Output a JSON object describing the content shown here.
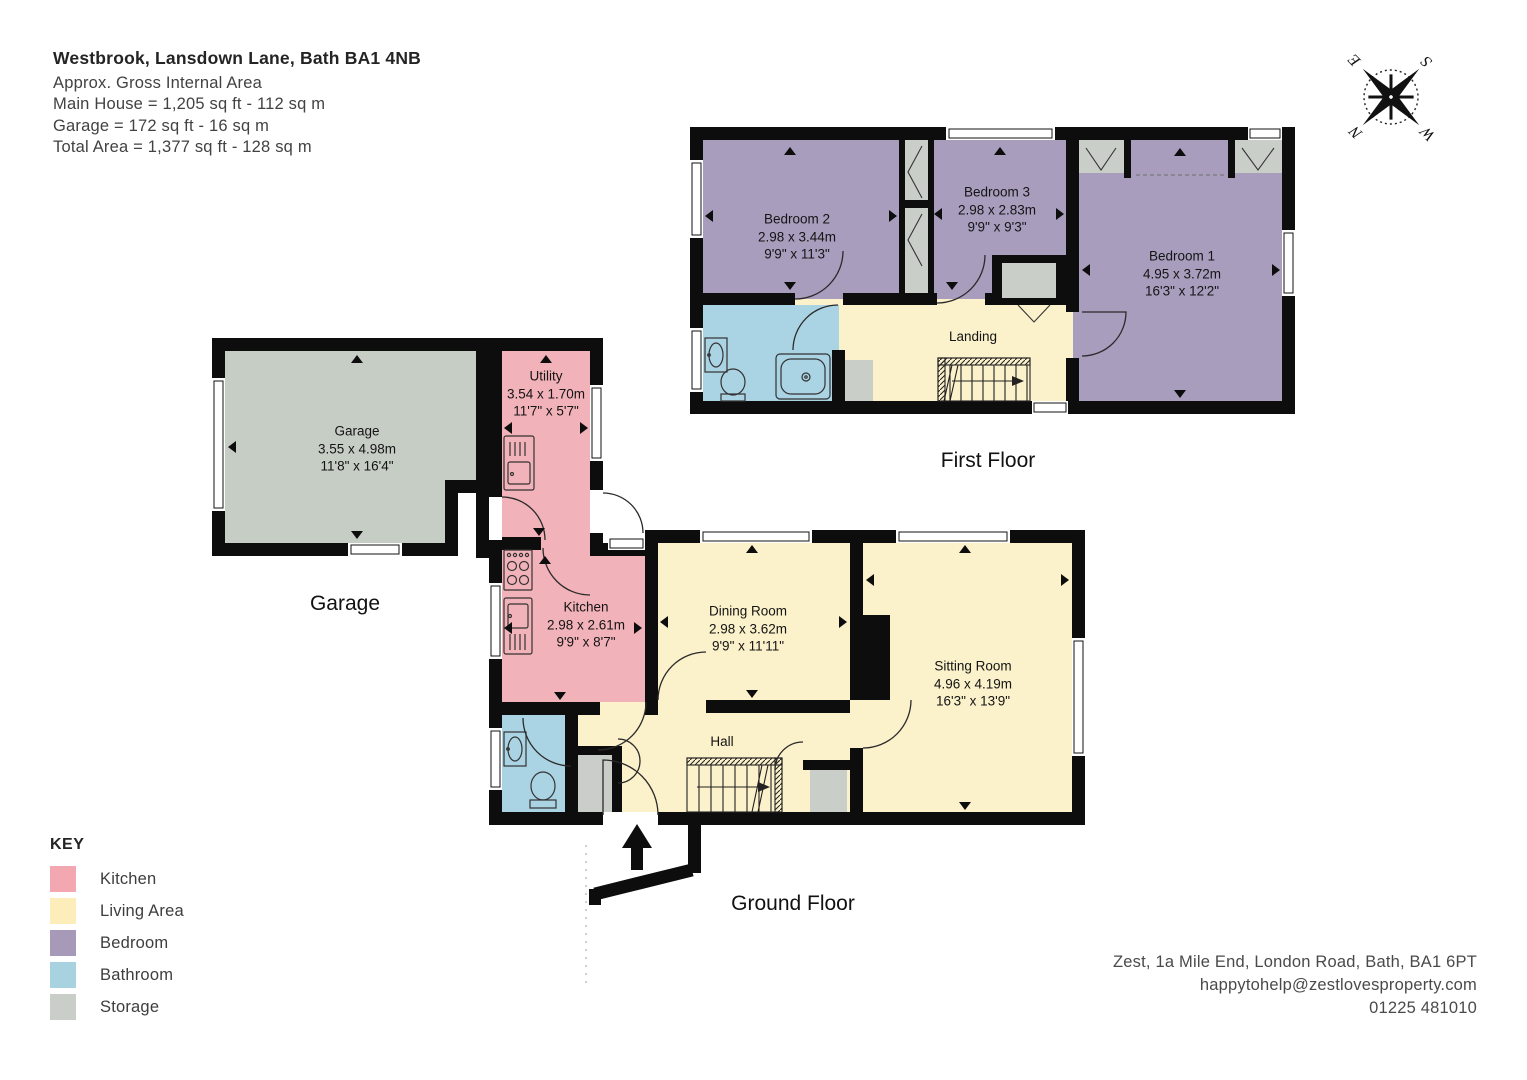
{
  "header": {
    "title": "Westbrook, Lansdown Lane, Bath  BA1 4NB",
    "area_lines": [
      "Approx. Gross Internal Area",
      "Main House = 1,205 sq ft - 112 sq m",
      "Garage = 172 sq ft - 16 sq m",
      "Total Area = 1,377 sq ft - 128 sq m"
    ]
  },
  "compass": {
    "n": "N",
    "e": "E",
    "s": "S",
    "w": "W"
  },
  "floors": {
    "first": {
      "label": "First Floor",
      "rooms": {
        "bedroom1": {
          "name": "Bedroom 1",
          "metric": "4.95 x 3.72m",
          "imperial": "16'3\" x 12'2\""
        },
        "bedroom2": {
          "name": "Bedroom 2",
          "metric": "2.98 x 3.44m",
          "imperial": "9'9\" x 11'3\""
        },
        "bedroom3": {
          "name": "Bedroom 3",
          "metric": "2.98 x 2.83m",
          "imperial": "9'9\" x 9'3\""
        },
        "landing": {
          "name": "Landing"
        }
      }
    },
    "ground": {
      "label": "Ground Floor",
      "rooms": {
        "utility": {
          "name": "Utility",
          "metric": "3.54 x 1.70m",
          "imperial": "11'7\" x 5'7\""
        },
        "kitchen": {
          "name": "Kitchen",
          "metric": "2.98 x 2.61m",
          "imperial": "9'9\" x 8'7\""
        },
        "dining": {
          "name": "Dining Room",
          "metric": "2.98 x 3.62m",
          "imperial": "9'9\" x 11'11\""
        },
        "sitting": {
          "name": "Sitting Room",
          "metric": "4.96 x 4.19m",
          "imperial": "16'3\" x 13'9\""
        },
        "hall": {
          "name": "Hall"
        }
      }
    },
    "garage": {
      "label": "Garage",
      "rooms": {
        "garage": {
          "name": "Garage",
          "metric": "3.55 x 4.98m",
          "imperial": "11'8\" x 16'4\""
        }
      }
    }
  },
  "key": {
    "title": "KEY",
    "items": [
      {
        "label": "Kitchen",
        "color": "#F3A8B1"
      },
      {
        "label": "Living Area",
        "color": "#FCEDBA"
      },
      {
        "label": "Bedroom",
        "color": "#A79AB9"
      },
      {
        "label": "Bathroom",
        "color": "#A8D2E0"
      },
      {
        "label": "Storage",
        "color": "#C9CEC9"
      }
    ]
  },
  "contact": {
    "address": "Zest, 1a Mile End, London Road, Bath, BA1 6PT",
    "email": "happytohelp@zestlovesproperty.com",
    "phone": "01225 481010"
  }
}
